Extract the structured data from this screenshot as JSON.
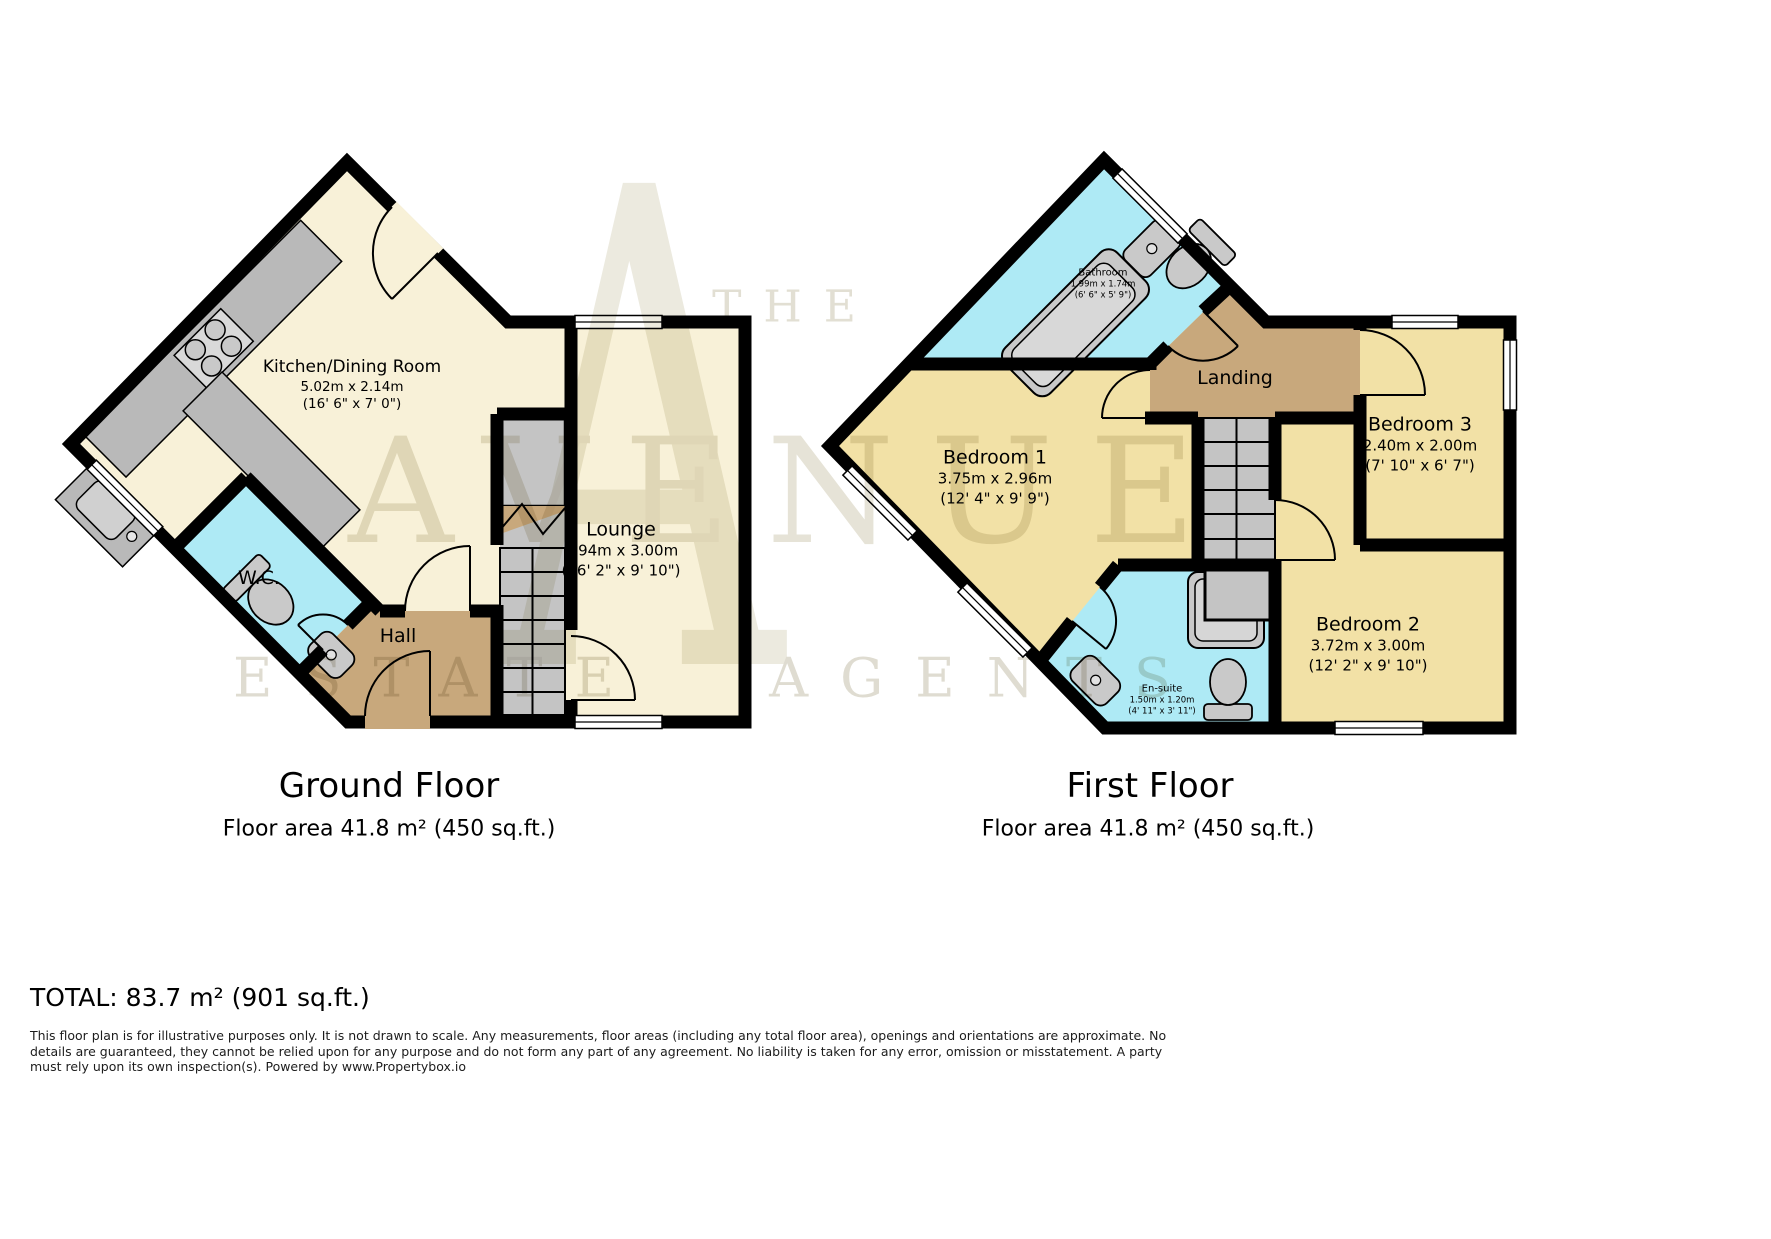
{
  "watermark": {
    "monogram": "A",
    "line1": "THE",
    "line2": "AVENUE",
    "line3": "ESTATE AGENTS"
  },
  "ground_floor": {
    "title": "Ground Floor",
    "area_label": "Floor area 41.8 m² (450 sq.ft.)",
    "rooms": {
      "kitchen": {
        "name": "Kitchen/Dining Room",
        "metric": "5.02m x 2.14m",
        "imperial": "(16' 6\" x 7' 0\")"
      },
      "lounge": {
        "name": "Lounge",
        "metric": "4.94m x 3.00m",
        "imperial": "(16' 2\" x 9' 10\")"
      },
      "wc": {
        "name": "W.C."
      },
      "hall": {
        "name": "Hall"
      }
    }
  },
  "first_floor": {
    "title": "First Floor",
    "area_label": "Floor area 41.8 m² (450 sq.ft.)",
    "rooms": {
      "bathroom": {
        "name": "Bathroom",
        "metric": "1.99m x 1.74m",
        "imperial": "(6' 6\" x 5' 9\")"
      },
      "bedroom1": {
        "name": "Bedroom 1",
        "metric": "3.75m x 2.96m",
        "imperial": "(12' 4\" x 9' 9\")"
      },
      "landing": {
        "name": "Landing"
      },
      "bedroom3": {
        "name": "Bedroom 3",
        "metric": "2.40m x 2.00m",
        "imperial": "(7' 10\" x 6' 7\")"
      },
      "bedroom2": {
        "name": "Bedroom 2",
        "metric": "3.72m x 3.00m",
        "imperial": "(12' 2\" x 9' 10\")"
      },
      "ensuite": {
        "name": "En-suite",
        "metric": "1.50m x 1.20m",
        "imperial": "(4' 11\" x 3' 11\")"
      }
    }
  },
  "total_label": "TOTAL: 83.7 m² (901 sq.ft.)",
  "disclaimer": "This floor plan is for illustrative purposes only. It is not drawn to scale. Any measurements, floor areas (including any total floor area), openings and orientations are approximate. No details are guaranteed, they cannot be relied upon for any purpose and do not form any part of any agreement. No liability is taken for any error, omission or misstatement. A party must rely upon its own inspection(s). Powered by www.Propertybox.io",
  "colors": {
    "wall": "#000000",
    "cream_room": "#f8f1d8",
    "yellow_room": "#f2e1a6",
    "wet_room": "#aeeaf5",
    "hall_landing": "#c8a87c",
    "fixture_gray": "#c9c9c9",
    "stairs_gray": "#c4c4c4",
    "watermark_gray": "#e4e1d6"
  }
}
